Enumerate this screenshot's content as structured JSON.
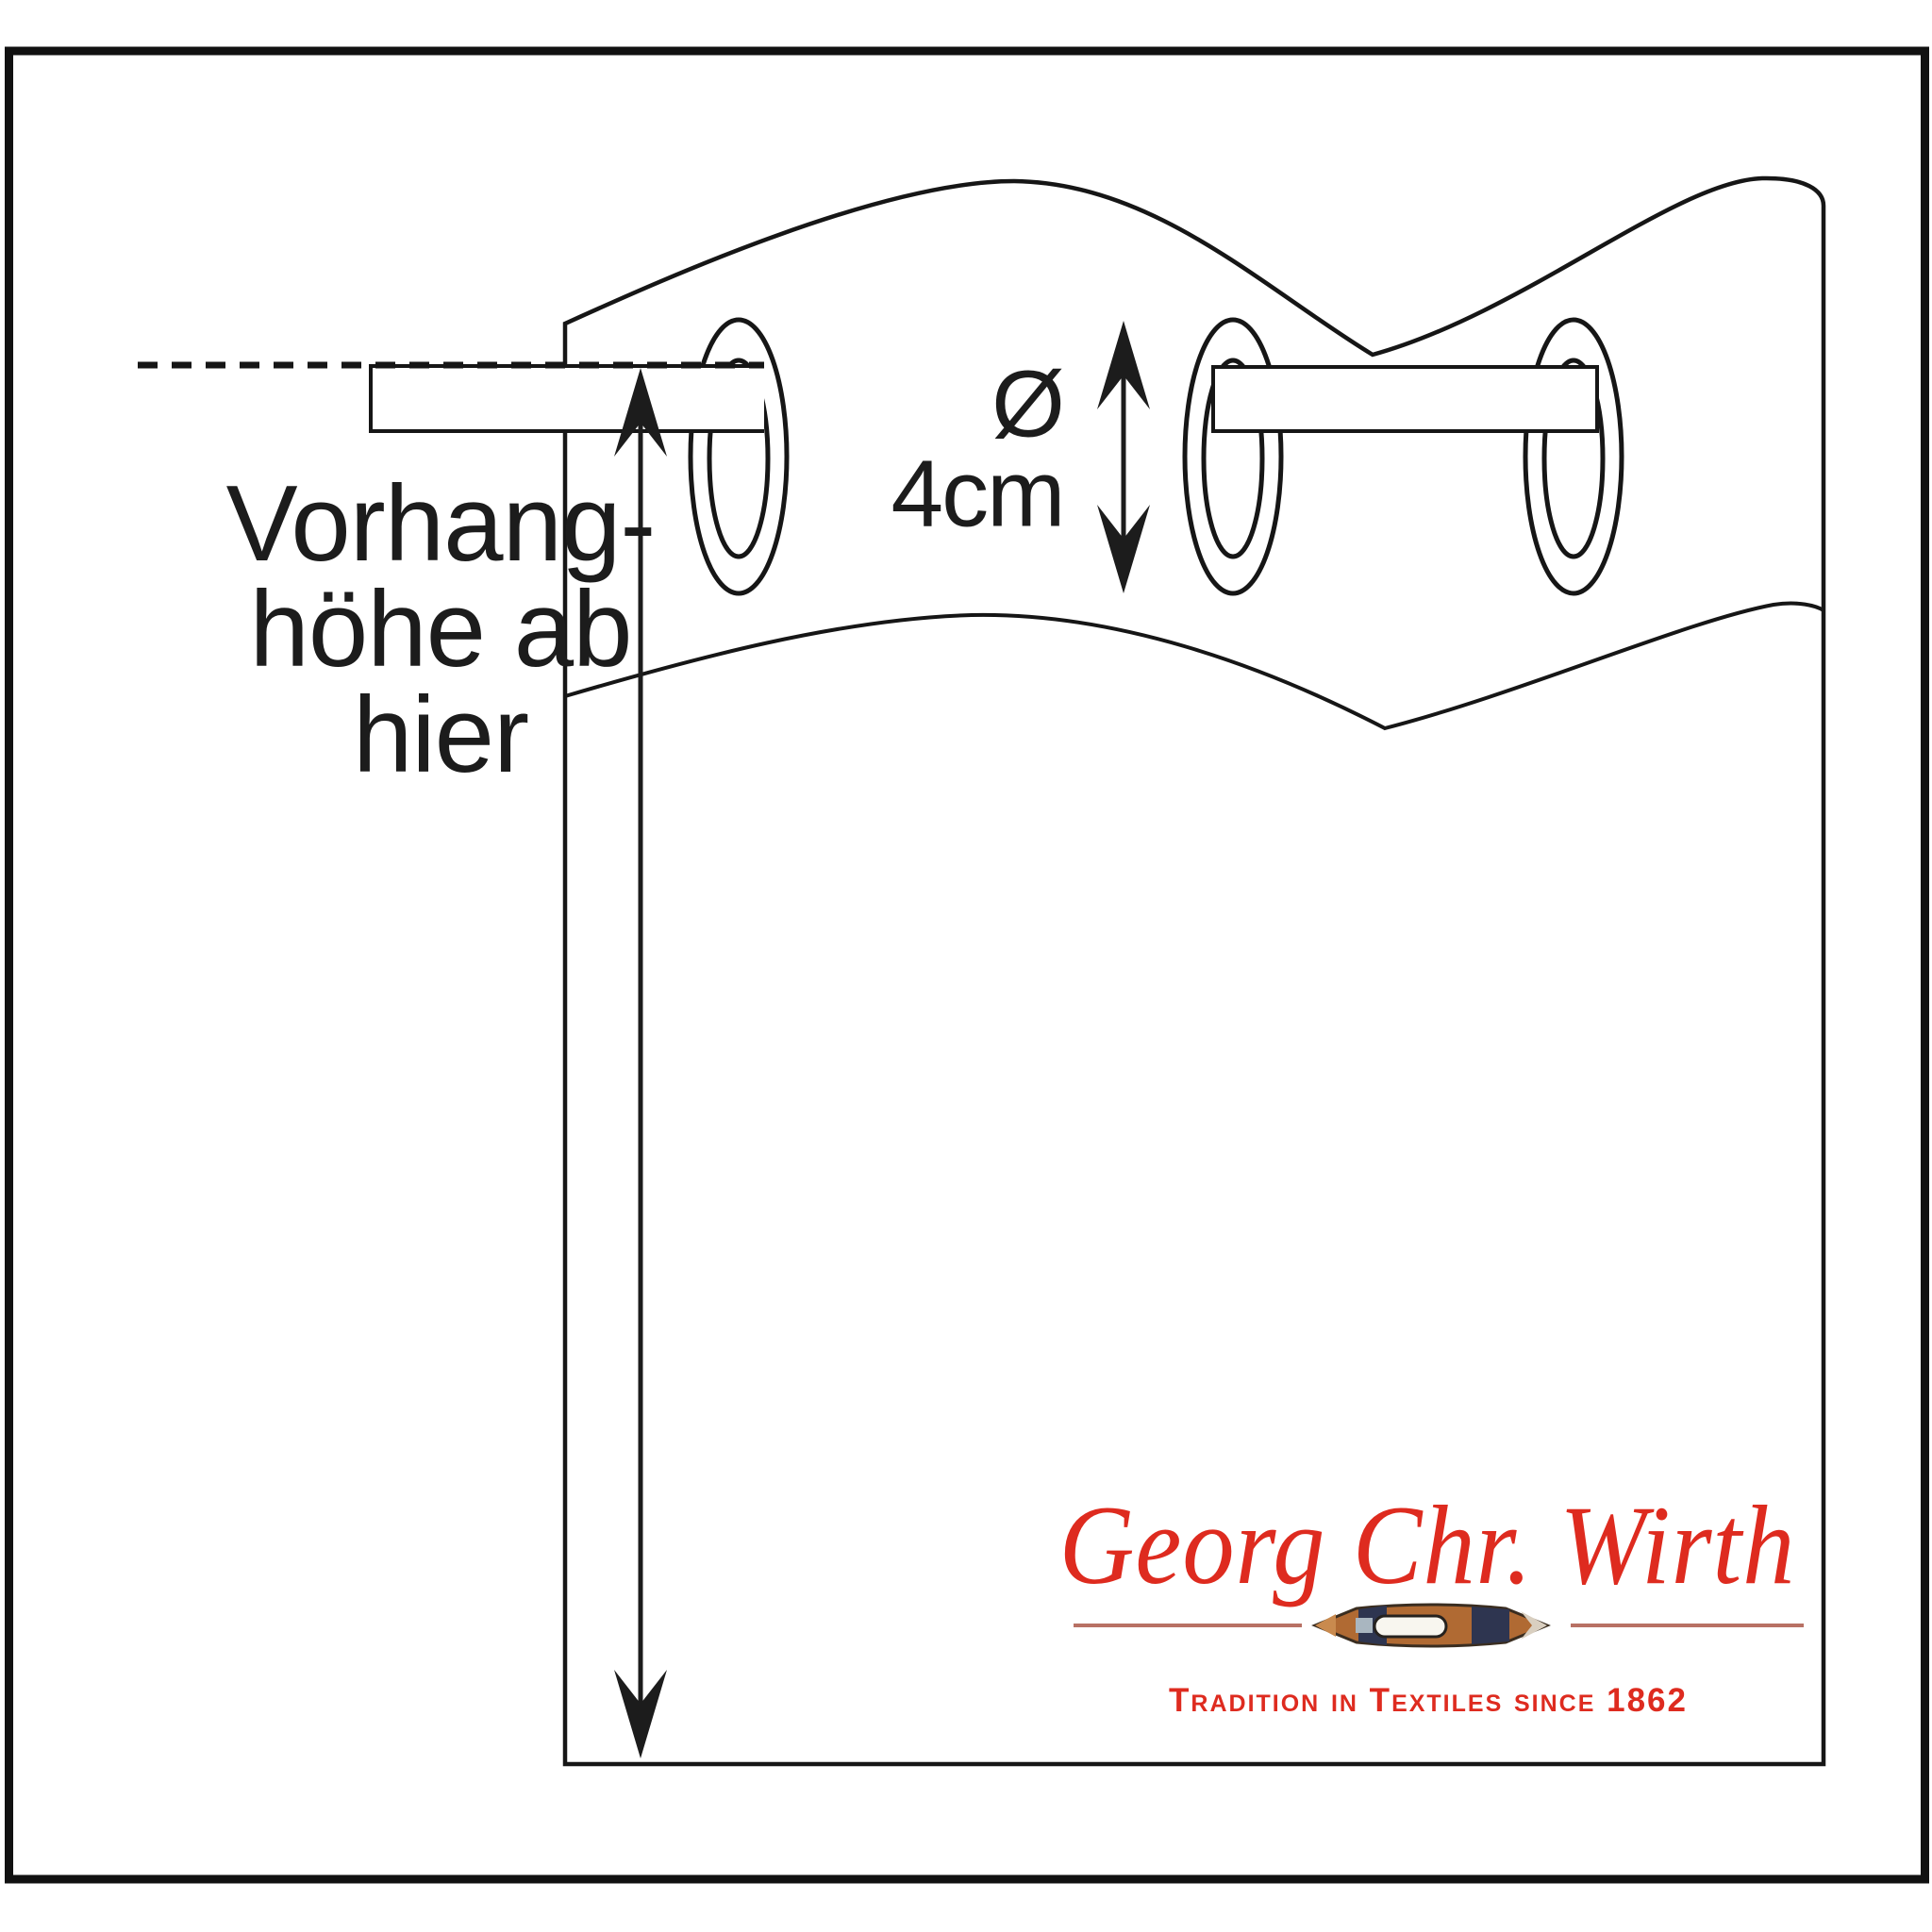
{
  "diagram": {
    "labels": {
      "curtain_height": {
        "line1": "Vorhang-",
        "line2": "höhe ab",
        "line3": "hier"
      },
      "eyelet_diameter": {
        "symbol": "Ø",
        "value": "4cm"
      }
    },
    "brand": {
      "wordmark": "Georg Chr. Wirth",
      "tagline": "Tradition in Textiles since 1862"
    },
    "icons": [
      "weaving-shuttle-icon",
      "height-arrow-icon",
      "diameter-arrow-icon"
    ],
    "colors": {
      "line_black": "#161616",
      "label_text": "#1c1c1c",
      "brand_red": "#de2b1f",
      "divider_rose": "#b87164",
      "shuttle_wood": "#b06a33",
      "shuttle_navy": "#2e3550",
      "shuttle_eye": "#f8f6ef"
    }
  }
}
